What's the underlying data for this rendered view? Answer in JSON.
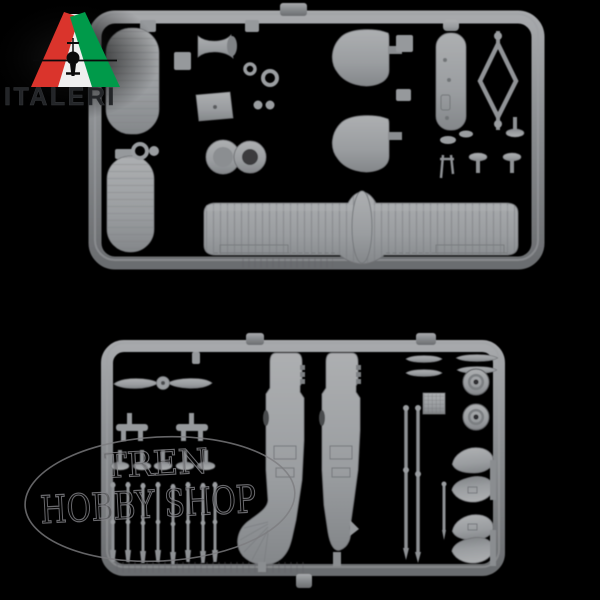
{
  "scene": {
    "subject": "grey injection-moulded model kit sprues on black background",
    "sprue_count": "2"
  },
  "colors": {
    "background": "#000000",
    "sprue_rail": "#85878a",
    "sprue_rail_light": "#a7a9ac",
    "sprue_rail_dark": "#6b6d70",
    "part_light": "#a9abae",
    "part_base": "#96999c",
    "part_shadow": "#6f7174",
    "logo_red": "#da342c",
    "logo_green": "#009a4a",
    "logo_white": "#efefef",
    "logo_text": "#232528",
    "watermark_stroke": "#84848a"
  },
  "logo": {
    "brand": "ITALERI"
  },
  "watermark": {
    "line1": "TREN",
    "line2": "HOBBY SHOP"
  },
  "top_sprue": {
    "parts": [
      "upper-wing-panel",
      "lower-wing-panel",
      "pilot-bulkhead",
      "cowl-front",
      "engine-cowling-rings",
      "tail-fin-upper",
      "tail-fin-lower",
      "fuselage-pod",
      "rigging-diamond-frame",
      "strut-profiles",
      "main-lower-wing"
    ]
  },
  "bottom_sprue": {
    "parts": [
      "two-blade-propeller",
      "axle-parts",
      "fuselage-half-left",
      "fuselage-half-right",
      "machine-gun-barrels",
      "prop-blades",
      "radiator-panel",
      "main-wheel",
      "main-wheel",
      "wheel-spat",
      "wheel-spat",
      "wheel-spat",
      "wheel-spat",
      "interplane-struts"
    ]
  }
}
